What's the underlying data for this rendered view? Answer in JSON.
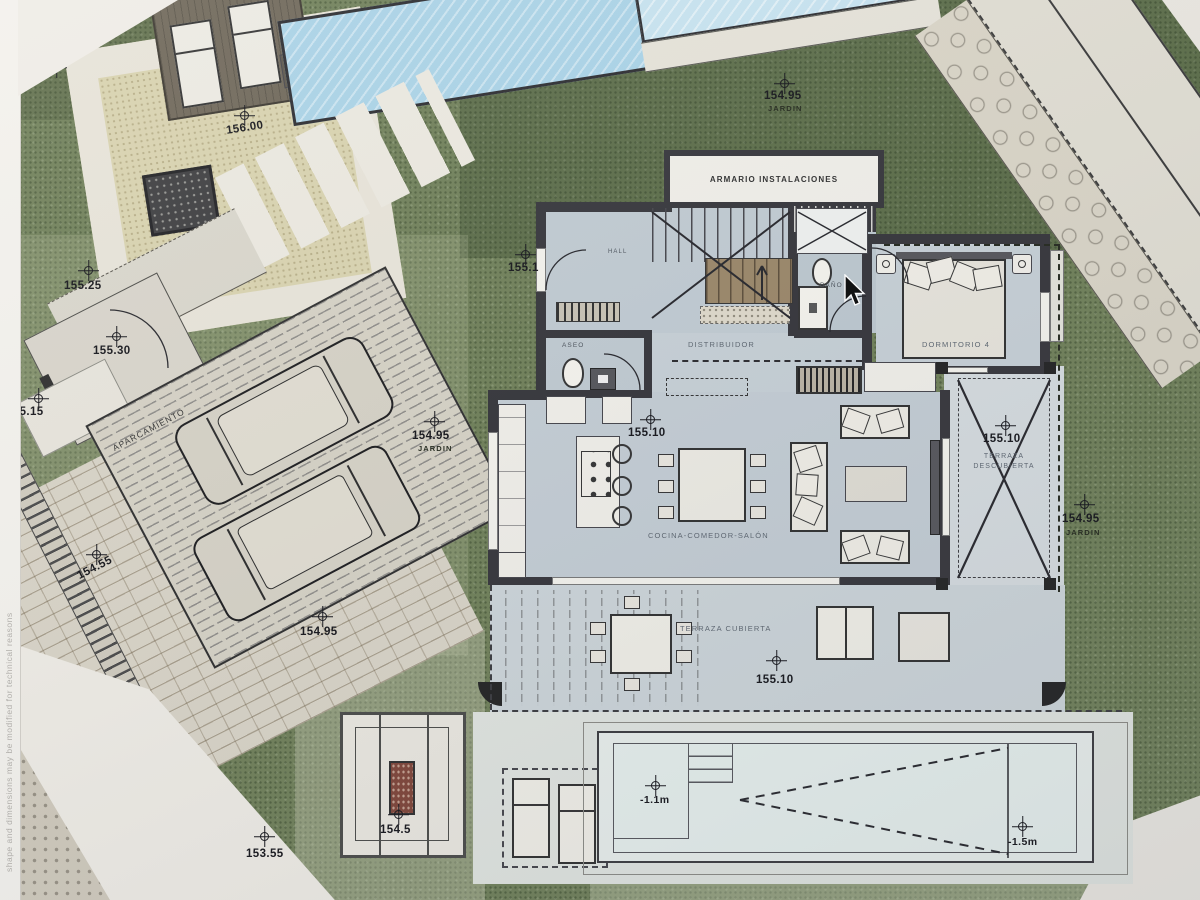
{
  "plan": {
    "disclaimer": "shape and dimensions may be modified for technical reasons",
    "rooms": {
      "armario": "ARMARIO INSTALACIONES",
      "hall": "HALL",
      "bano": "BAÑO",
      "distribuidor": "DISTRIBUIDOR",
      "dormitorio4": "DORMITORIO 4",
      "aseo": "ASEO",
      "cocina": "COCINA-COMEDOR-SALÓN",
      "terraza_descubierta": "TERRAZA DESCUBIERTA",
      "terraza_cubierta": "TERRAZA CUBIERTA",
      "aparcamiento": "APARCAMIENTO",
      "jardin": "JARDIN"
    },
    "elevations": {
      "e155_50": "155.50",
      "e156_00": "156.00",
      "e154_95_n": "154.95",
      "e155_25": "155.25",
      "e155_30": "155.30",
      "e155_15": "155.15",
      "e154_95_w": "154.95",
      "e155_1": "155.1",
      "e155_10_salon": "155.10",
      "e155_10_terraza_d": "155.10",
      "e154_95_e": "154.95",
      "e155_10_terraza_c": "155.10",
      "e154_95_s": "154.95",
      "e154_55": "154.55",
      "e154_5": "154.5",
      "e153_55": "153.55"
    },
    "pool": {
      "depth_shallow": "-1.1m",
      "depth_deep": "-1.5m"
    },
    "colors": {
      "grass": "#6f7f58",
      "floor": "#c6cfd5",
      "wall": "#35353a",
      "pool": "#a9d2e6",
      "paper": "#ece9e2",
      "deck": "#6e6658",
      "sand": "#d8d2ae"
    }
  }
}
